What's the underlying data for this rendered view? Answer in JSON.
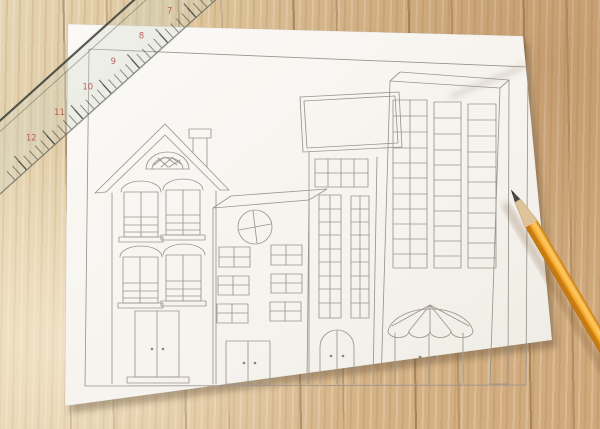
{
  "scene": {
    "type": "photograph",
    "description": "Hand-drawn pencil sketch of a city street with four buildings on a white sheet of paper, lying on a rustic wooden table. A clear plastic ruler lies diagonally across the top-left corner and a sharpened yellow pencil rests on the right edge pointing to the upper left.",
    "surface": "weathered wooden planks"
  },
  "colors": {
    "wood_base": "#d7b88c",
    "wood_dark_streak": "#6e4e2c",
    "paper": "#f8f6f2",
    "pencil_line": "#9a948c",
    "frame_line": "#55555a",
    "ruler_number": "#b03b3b",
    "pencil_body": "#f0a127",
    "pencil_wood": "#dfc39a",
    "pencil_graphite": "#4a4741"
  },
  "drawing": {
    "frame": "hand-ruled rectangular border around the scene",
    "buildings": [
      {
        "name": "gabled house",
        "features": [
          "triangular roof with double outline",
          "chimney with cap",
          "lattice fan window in gable",
          "four arched sash windows with sills",
          "double front door with step"
        ]
      },
      {
        "name": "flat-roof mid-rise",
        "features": [
          "three-dimensional flat top",
          "round porthole window",
          "six small paned windows",
          "double door"
        ]
      },
      {
        "name": "shop with blank billboard",
        "features": [
          "blank sign board on roof",
          "transom window grid",
          "two tall multi-pane windows",
          "arched double door"
        ]
      },
      {
        "name": "skyscraper",
        "features": [
          "three-dimensional top and side",
          "three columns of stacked windows",
          "scalloped dome awning",
          "double door"
        ]
      }
    ]
  },
  "ruler": {
    "material": "clear plastic with tick marks",
    "numbers": [
      "12",
      "11",
      "10",
      "9",
      "8",
      "7",
      "6",
      "5"
    ],
    "number_color": "#b03b3b"
  },
  "pencil": {
    "type": "sharpened yellow wood pencil",
    "pointing": "upper-left"
  }
}
